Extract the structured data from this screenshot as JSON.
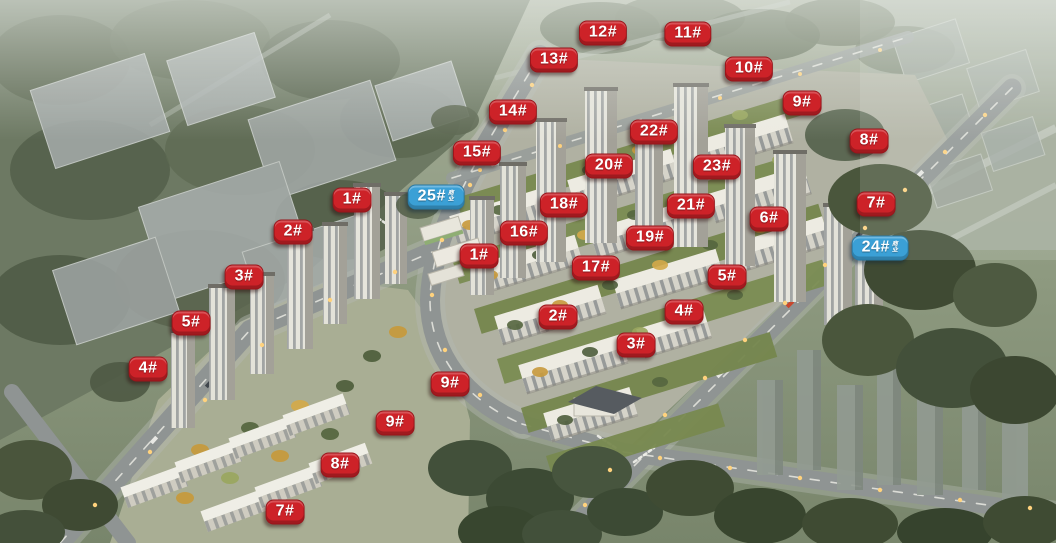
{
  "colors": {
    "badge_red": "#cd2228",
    "badge_blue": "#3ba0d6",
    "badge_text": "#ffffff"
  },
  "badges": [
    {
      "label": "12#",
      "type": "red",
      "x": 603,
      "y": 33
    },
    {
      "label": "11#",
      "type": "red",
      "x": 688,
      "y": 34
    },
    {
      "label": "13#",
      "type": "red",
      "x": 554,
      "y": 60
    },
    {
      "label": "10#",
      "type": "red",
      "x": 749,
      "y": 69
    },
    {
      "label": "9#",
      "type": "red",
      "x": 802,
      "y": 103
    },
    {
      "label": "14#",
      "type": "red",
      "x": 513,
      "y": 112
    },
    {
      "label": "22#",
      "type": "red",
      "x": 654,
      "y": 132
    },
    {
      "label": "8#",
      "type": "red",
      "x": 869,
      "y": 141
    },
    {
      "label": "15#",
      "type": "red",
      "x": 477,
      "y": 153
    },
    {
      "label": "20#",
      "type": "red",
      "x": 609,
      "y": 166
    },
    {
      "label": "23#",
      "type": "red",
      "x": 717,
      "y": 167
    },
    {
      "label": "25#",
      "type": "blue",
      "x": 436,
      "y": 197,
      "suffix": "商业"
    },
    {
      "label": "1#",
      "type": "red",
      "x": 352,
      "y": 200
    },
    {
      "label": "7#",
      "type": "red",
      "x": 876,
      "y": 204
    },
    {
      "label": "18#",
      "type": "red",
      "x": 564,
      "y": 205
    },
    {
      "label": "21#",
      "type": "red",
      "x": 691,
      "y": 206
    },
    {
      "label": "6#",
      "type": "red",
      "x": 769,
      "y": 219
    },
    {
      "label": "2#",
      "type": "red",
      "x": 293,
      "y": 232
    },
    {
      "label": "16#",
      "type": "red",
      "x": 524,
      "y": 233
    },
    {
      "label": "19#",
      "type": "red",
      "x": 650,
      "y": 238
    },
    {
      "label": "24#",
      "type": "blue",
      "x": 880,
      "y": 248,
      "suffix": "商业"
    },
    {
      "label": "1#",
      "type": "red",
      "x": 479,
      "y": 256
    },
    {
      "label": "17#",
      "type": "red",
      "x": 596,
      "y": 268
    },
    {
      "label": "3#",
      "type": "red",
      "x": 244,
      "y": 277
    },
    {
      "label": "5#",
      "type": "red",
      "x": 727,
      "y": 277
    },
    {
      "label": "4#",
      "type": "red",
      "x": 684,
      "y": 312
    },
    {
      "label": "2#",
      "type": "red",
      "x": 558,
      "y": 317
    },
    {
      "label": "5#",
      "type": "red",
      "x": 191,
      "y": 323
    },
    {
      "label": "3#",
      "type": "red",
      "x": 636,
      "y": 345
    },
    {
      "label": "4#",
      "type": "red",
      "x": 148,
      "y": 369
    },
    {
      "label": "9#",
      "type": "red",
      "x": 450,
      "y": 384
    },
    {
      "label": "9#",
      "type": "red",
      "x": 395,
      "y": 423
    },
    {
      "label": "8#",
      "type": "red",
      "x": 340,
      "y": 465
    },
    {
      "label": "7#",
      "type": "red",
      "x": 285,
      "y": 512
    }
  ]
}
